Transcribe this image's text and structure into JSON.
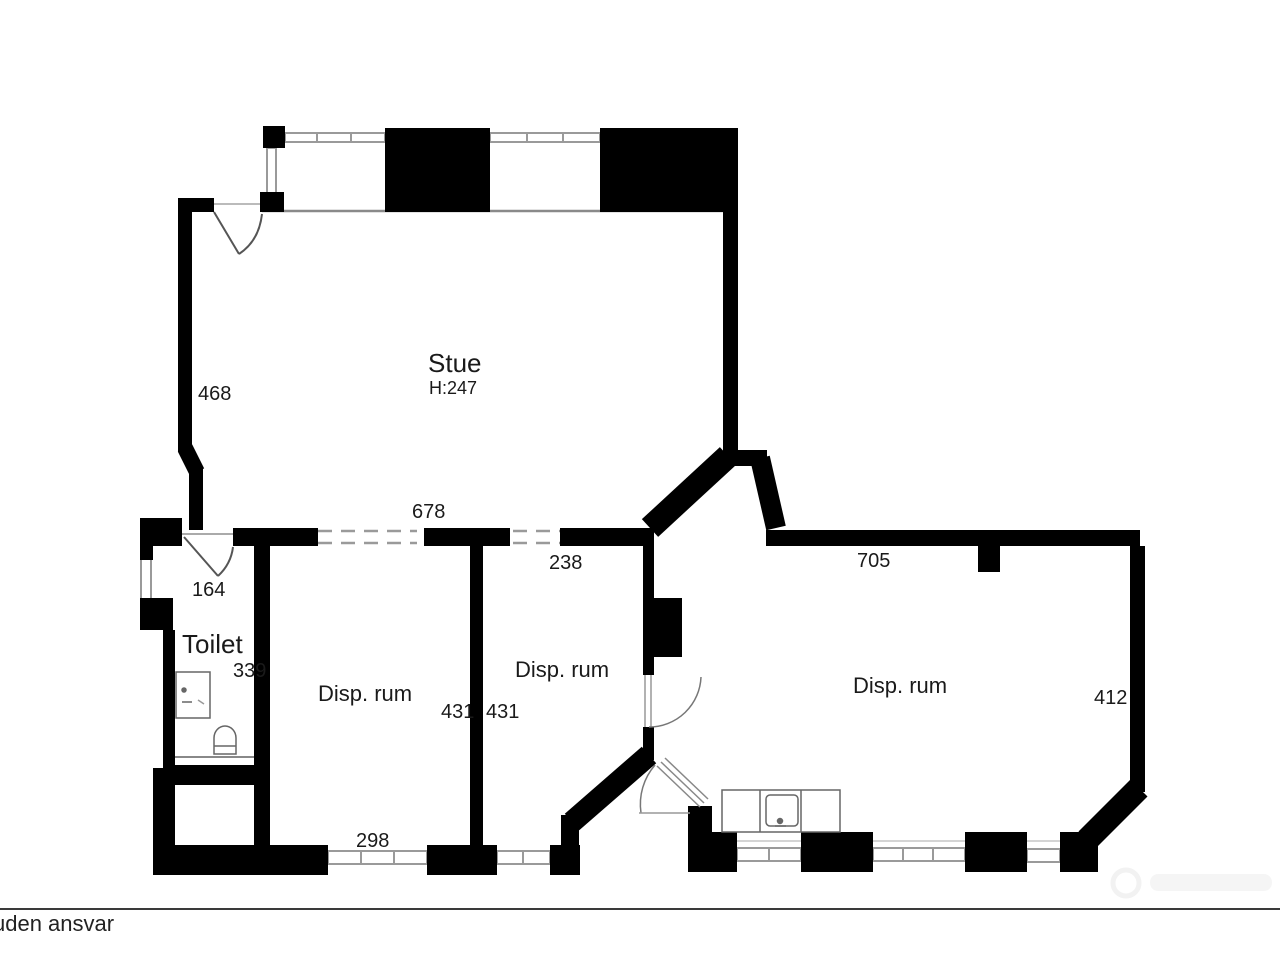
{
  "plan": {
    "rooms": {
      "stue": {
        "name": "Stue",
        "ceiling_height": "H:247"
      },
      "toilet": {
        "name": "Toilet"
      },
      "disp_rum_left": {
        "name": "Disp. rum"
      },
      "disp_rum_middle": {
        "name": "Disp. rum"
      },
      "disp_rum_right": {
        "name": "Disp. rum"
      }
    },
    "dimensions": {
      "stue_left_wall": "468",
      "stue_bottom_opening": "678",
      "middle_opening": "238",
      "toilet_door": "164",
      "toilet_width": "339",
      "disp_left_width": "431",
      "disp_middle_width": "431",
      "disp_left_window": "298",
      "disp_right_top": "705",
      "disp_right_side": "412"
    }
  },
  "footer": {
    "disclaimer": "uden ansvar"
  },
  "colors": {
    "wall": "#000000",
    "window_line": "#9a9a9a",
    "dashed_opening": "#9a9a9a",
    "text": "#1a1a1a",
    "background": "#ffffff"
  }
}
